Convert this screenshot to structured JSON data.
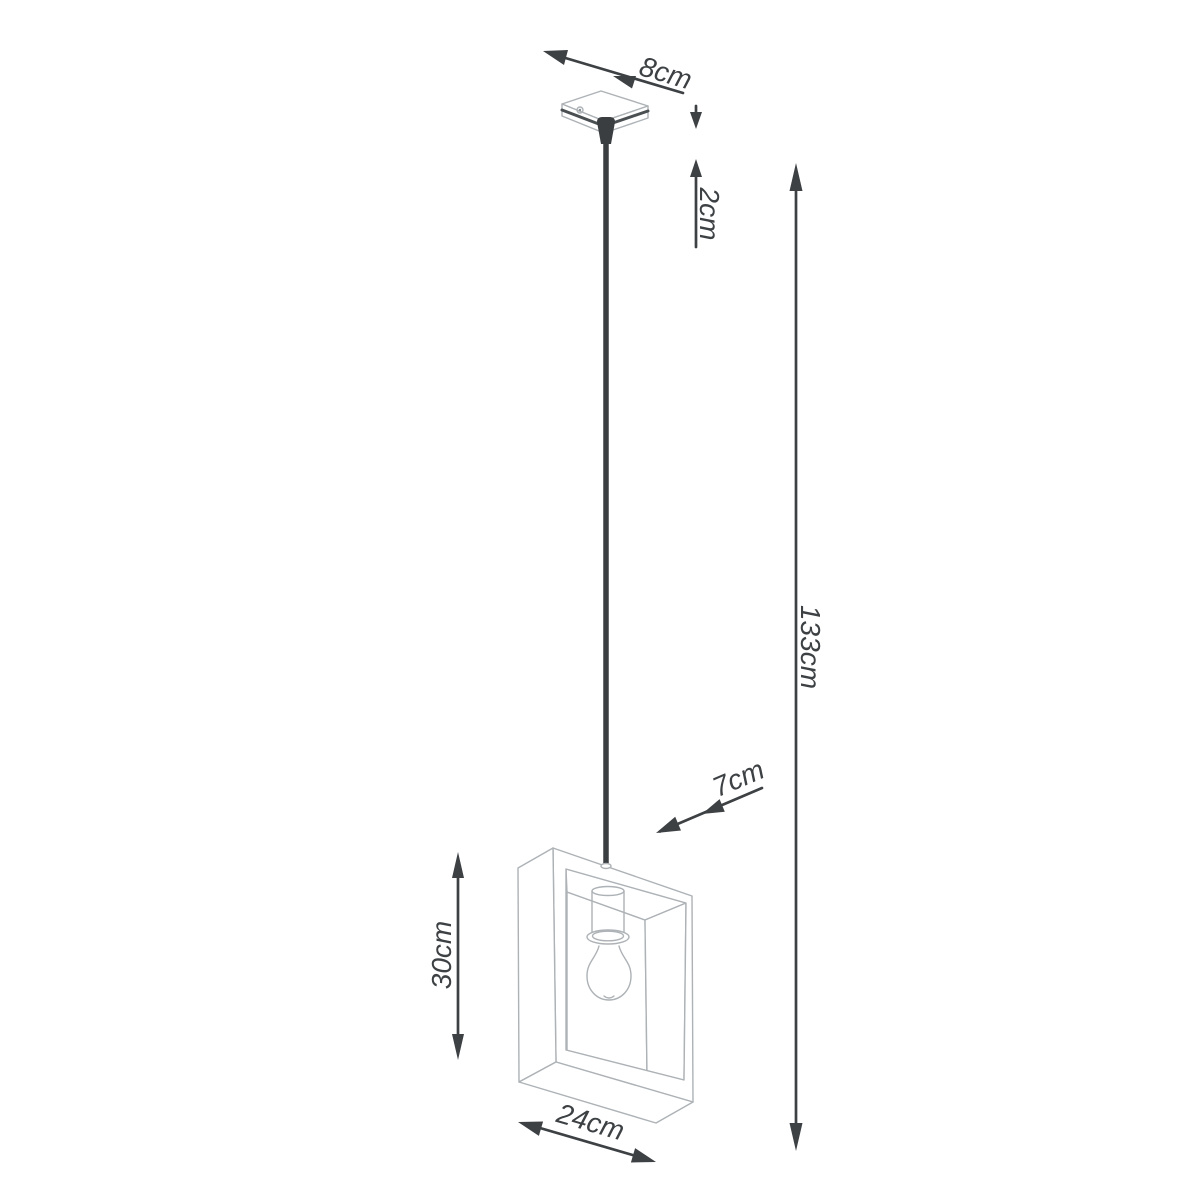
{
  "diagram": {
    "type": "product dimension line drawing",
    "subject": "single pendant ceiling lamp with open square frame shade and exposed bulb",
    "background_color": "#ffffff",
    "colors": {
      "dimension": "#3d4144",
      "product_outline": "#adb2b6",
      "product_shadow_edge": "#4a4f52",
      "cord": "#3a3e41",
      "screw_dot": "#8a8f93"
    },
    "dimensions": {
      "canopy_width": "8cm",
      "canopy_height": "2cm",
      "total_hanging_height": "133cm",
      "shade_depth": "7cm",
      "shade_height": "30cm",
      "shade_width": "24cm"
    },
    "parts": [
      "ceiling-canopy",
      "suspension-cord",
      "square-frame-shade",
      "bulb-socket",
      "light-bulb"
    ]
  }
}
